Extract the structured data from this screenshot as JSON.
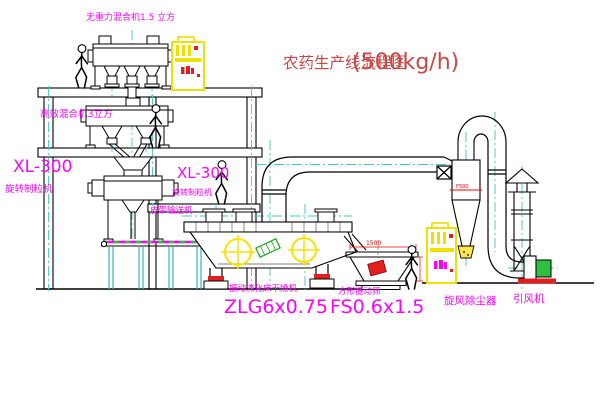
{
  "title": {
    "text": "农药生产线流程图",
    "capacity": "(500kg/h)"
  },
  "labels": {
    "gravity_mixer": "无重力混合机1.5 立方",
    "high_mixer": "高效混合机3立方",
    "granulator_left_model": "XL-300",
    "granulator_left_name": "旋转制粒机",
    "granulator_mid_model": "XL-300",
    "granulator_mid_name": "旋转制粒机",
    "belt_conveyor": "皮带输送机",
    "dryer_name": "振动流化床干燥机",
    "dryer_model": "ZLG6x0.75",
    "sieve_name": "方形振动筛",
    "sieve_model": "FS0.6x1.5",
    "cyclone_name": "旋风除尘器",
    "fan_name": "引风机"
  },
  "dimensions": {
    "sieve_length": "1500",
    "sieve_height": "541",
    "cyclone_marking": "F500"
  },
  "colors": {
    "label_magenta": "#ff00ff",
    "title_red": "#cd4646",
    "dimension_red": "#ff0000",
    "centerline_cyan": "#3fc9c9",
    "cabinet_yellow": "#f0e000",
    "symbol_yellow": "#f5e400",
    "motor_green": "#2ebf3e",
    "line_black": "#000000",
    "background": "#ffffff"
  }
}
